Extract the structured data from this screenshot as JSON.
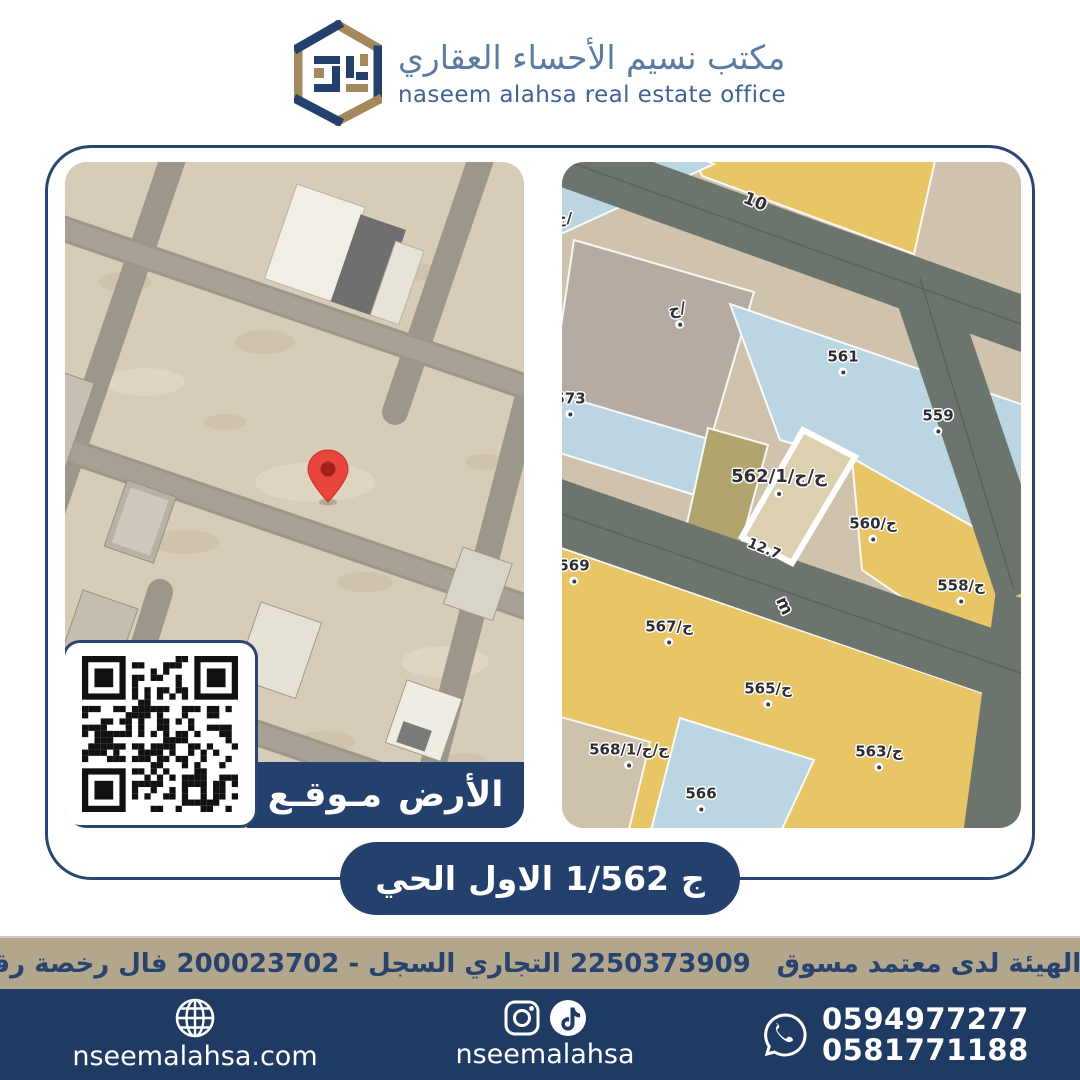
{
  "header": {
    "title_ar": "مكتب نسيم الأحساء العقاري",
    "subtitle_en": "naseem alahsa real estate office"
  },
  "card": {
    "location_badge": {
      "parts": [
        "مـوقـع",
        "الأرض"
      ],
      "text": "موقع الأرض"
    },
    "district_banner": {
      "parts": [
        "الحي",
        "الاول",
        "1/562",
        "ج"
      ],
      "text": "الحي الاول 562/1 ج"
    },
    "left_map": {
      "type": "satellite",
      "has_location_pin": true,
      "pin_color": "#e8453c"
    },
    "right_map": {
      "type": "parcel-plan",
      "highlighted_parcel": "562/1",
      "highlighted_parcel_dimension": "12.7",
      "labels": [
        {
          "text": "10",
          "x": 193,
          "y": 40,
          "rot": 22,
          "size": 17,
          "dot": false
        },
        {
          "text": "ج/",
          "x": 2,
          "y": 56,
          "rot": 0,
          "size": 15,
          "dot": false
        },
        {
          "text": "ج/",
          "x": 116,
          "y": 152,
          "rot": -10,
          "size": 16,
          "dot": true
        },
        {
          "text": "561",
          "x": 281,
          "y": 200,
          "rot": 0,
          "size": 15,
          "dot": true
        },
        {
          "text": "573",
          "x": 8,
          "y": 242,
          "rot": 0,
          "size": 15,
          "dot": true
        },
        {
          "text": "559",
          "x": 376,
          "y": 259,
          "rot": 0,
          "size": 15,
          "dot": true
        },
        {
          "text": "ج/ج/562/1",
          "x": 217,
          "y": 320,
          "rot": 0,
          "size": 18,
          "dot": true
        },
        {
          "text": "ج/560",
          "x": 311,
          "y": 367,
          "rot": 0,
          "size": 15,
          "dot": true
        },
        {
          "text": "12.7",
          "x": 202,
          "y": 387,
          "rot": 22,
          "size": 14,
          "dot": false
        },
        {
          "text": "569",
          "x": 12,
          "y": 409,
          "rot": 0,
          "size": 15,
          "dot": true
        },
        {
          "text": "m",
          "x": 222,
          "y": 444,
          "rot": 65,
          "size": 17,
          "dot": false
        },
        {
          "text": "ج/558",
          "x": 399,
          "y": 429,
          "rot": 0,
          "size": 15,
          "dot": true
        },
        {
          "text": "ج/567",
          "x": 107,
          "y": 470,
          "rot": 0,
          "size": 15,
          "dot": true
        },
        {
          "text": "ج/565",
          "x": 206,
          "y": 532,
          "rot": 0,
          "size": 15,
          "dot": true
        },
        {
          "text": "ج/ج/568/1",
          "x": 67,
          "y": 593,
          "rot": 0,
          "size": 15,
          "dot": true
        },
        {
          "text": "ج/563",
          "x": 317,
          "y": 595,
          "rot": 0,
          "size": 15,
          "dot": true
        },
        {
          "text": "566",
          "x": 139,
          "y": 637,
          "rot": 0,
          "size": 15,
          "dot": true
        }
      ]
    }
  },
  "license_bar": {
    "words": [
      "مسوق",
      "معتمد",
      "لدى",
      "الهيئة",
      "العامة",
      "للعقار",
      "-",
      "رقم",
      "رخصة",
      "فال",
      "200023702",
      "-",
      "السجل",
      "التجاري",
      "2250373909"
    ],
    "text": "مسوق معتمد لدى الهيئة العامة للعقار - رقم رخصة فال 200023702 - السجل التجاري 2250373909"
  },
  "footer": {
    "website": "nseemalahsa.com",
    "social_handle": "nseemalahsa",
    "phones": [
      "0594977277",
      "0581771188"
    ]
  },
  "colors": {
    "brand_navy": "#24416d",
    "brand_gold": "#a3895c",
    "license_bar_bg": "#b2a68d",
    "license_text": "#27436e",
    "pin_red": "#e8453c",
    "parcel_yellow": "#e8c566",
    "parcel_blue": "#bcd5e2",
    "parcel_highlight_border": "#ffffff"
  }
}
